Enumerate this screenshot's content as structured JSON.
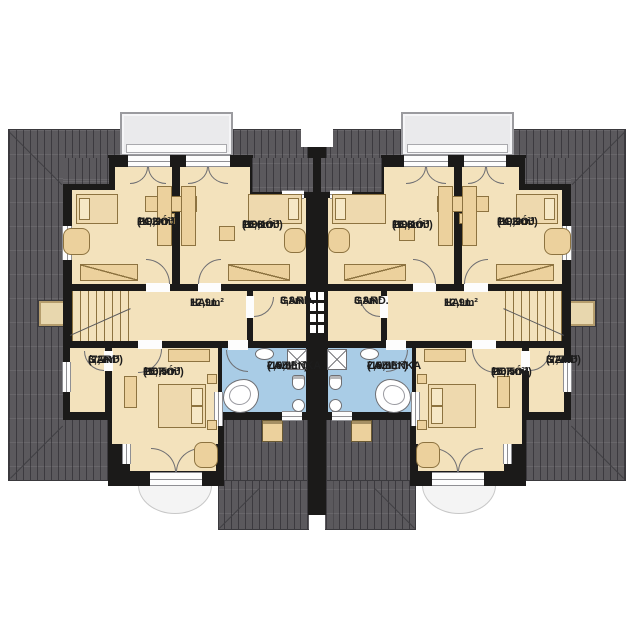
{
  "units": [
    {
      "id": "left-unit",
      "rooms": {
        "pokoj_a": {
          "name": "POKÓJ",
          "area": "14,2m²",
          "area_total": "(19,9m²)"
        },
        "pokoj_b": {
          "name": "POKÓJ",
          "area": "16,6m²",
          "area_total": "(19,1m²)"
        },
        "hall": {
          "name": "HALL",
          "area": "12,9m²"
        },
        "gard_center": {
          "name": "GARD.",
          "area": "3,8m²"
        },
        "gard_side": {
          "name": "GARD",
          "area": "3,2m²",
          "area_total": "(7,7m²)"
        },
        "pokoj_c": {
          "name": "POKÓJ",
          "area": "15,7m²",
          "area_total": "(16,5m²)"
        },
        "bathroom": {
          "name": "ŁAZIENKA",
          "area": "7,5m²",
          "area_total": "(10,8m²)"
        }
      }
    },
    {
      "id": "right-unit",
      "rooms": {
        "pokoj_a": {
          "name": "POKÓJ",
          "area": "14,2m²",
          "area_total": "(19,9m²)"
        },
        "pokoj_b": {
          "name": "POKÓJ",
          "area": "16,6m²",
          "area_total": "(19,1m²)"
        },
        "hall": {
          "name": "HALL",
          "area": "12,9m²"
        },
        "gard_center": {
          "name": "GARD.",
          "area": "3,8m²"
        },
        "gard_side": {
          "name": "GARD",
          "area": "3,2m²",
          "area_total": "(7,7m²)"
        },
        "pokoj_c": {
          "name": "POKÓJ",
          "area": "15,7m²",
          "area_total": "(16,5m²)"
        },
        "bathroom": {
          "name": "ŁAZIENKA",
          "area": "7,5m²",
          "area_total": "(10,8m²)"
        }
      }
    }
  ],
  "colors": {
    "roof": "#5b595d",
    "wall": "#1b1a19",
    "room": "#f3e2bc",
    "bath": "#a9cce6",
    "furn": "#ecd19d",
    "dormer": "#eaeaec",
    "terrace": "#f4f4f4"
  }
}
